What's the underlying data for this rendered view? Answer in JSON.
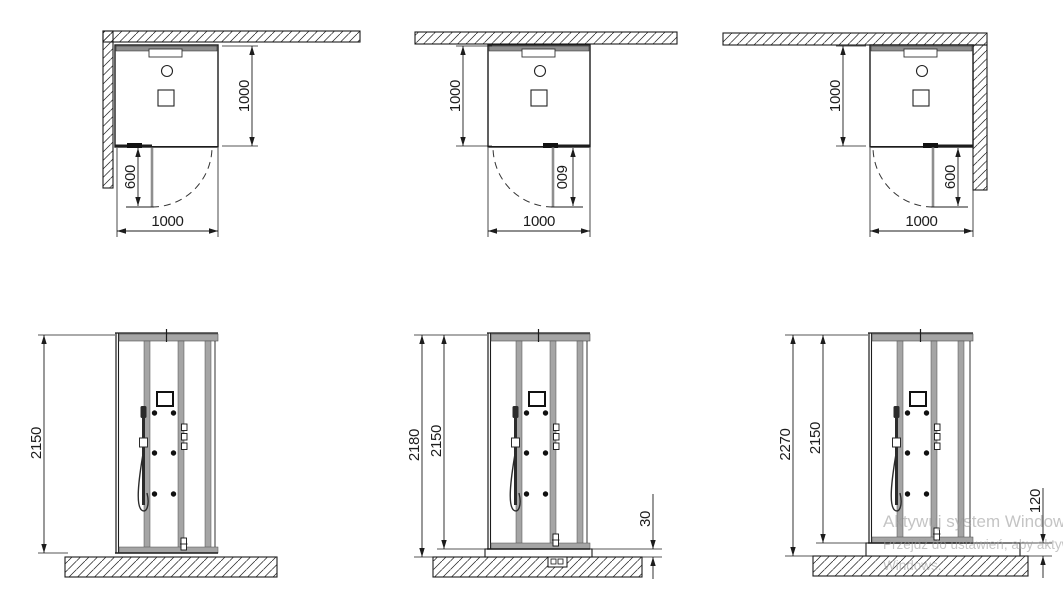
{
  "watermark": {
    "line1": "Aktywuj system Windows",
    "line2": "Przejdź do ustawień, aby aktywować system",
    "line3": "Windows."
  },
  "colors": {
    "line": "#1c1c1c",
    "frame": "#a5a5a5",
    "frame_edge": "#4d4d4d",
    "door_open": "#8f8f8f",
    "background": "#ffffff",
    "watermark": "#9e9e9e"
  },
  "top_views": [
    {
      "name": "top-view-corner-left",
      "position": "walls-back-and-left",
      "dim_depth": "1000",
      "dim_door": "600",
      "dim_width": "1000"
    },
    {
      "name": "top-view-back-wall",
      "position": "wall-back-only",
      "dim_depth": "1000",
      "dim_door": "600",
      "dim_width": "1000"
    },
    {
      "name": "top-view-corner-right",
      "position": "walls-back-and-right",
      "dim_depth": "1000",
      "dim_door": "600",
      "dim_width": "1000"
    }
  ],
  "elevations": [
    {
      "name": "elevation-no-tray",
      "dim_heights": [
        "2150"
      ],
      "dim_base": null
    },
    {
      "name": "elevation-tray-30",
      "dim_heights": [
        "2180",
        "2150"
      ],
      "dim_base": "30"
    },
    {
      "name": "elevation-tray-120",
      "dim_heights": [
        "2270",
        "2150"
      ],
      "dim_base": "120"
    }
  ]
}
